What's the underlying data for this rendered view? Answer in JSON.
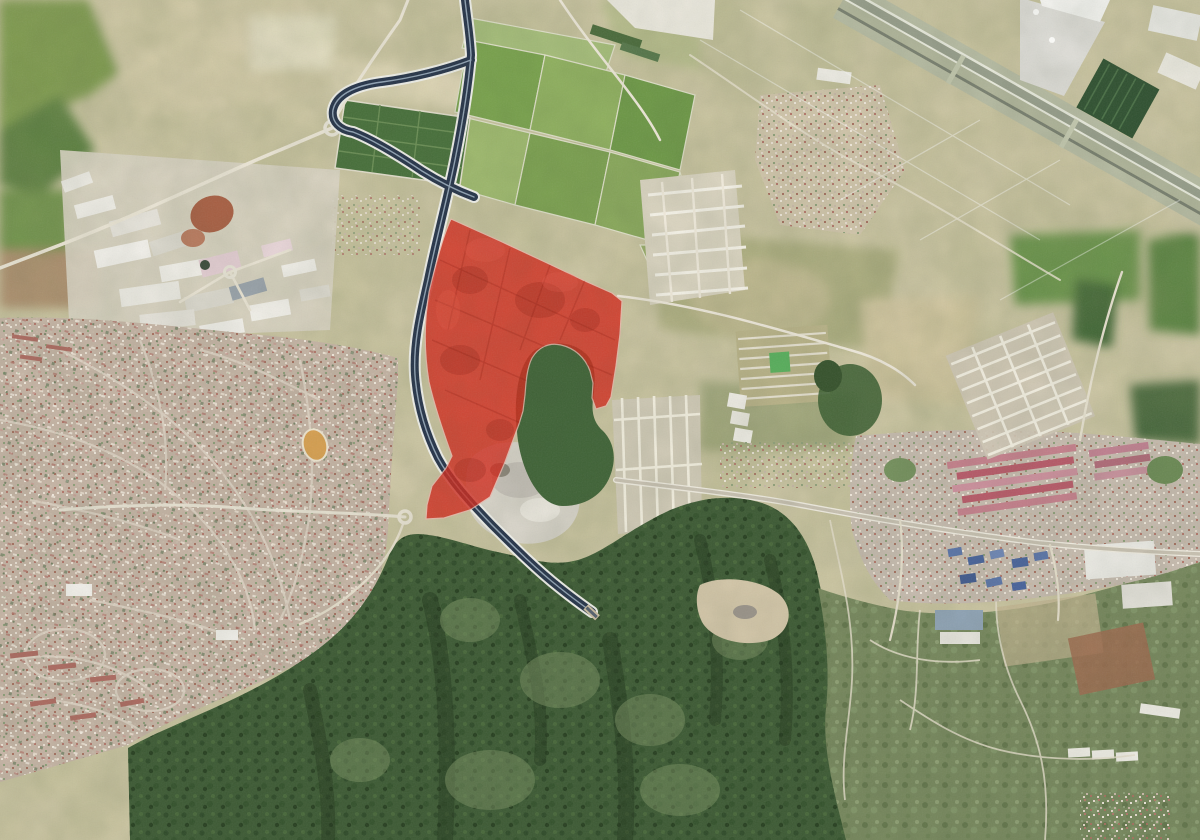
{
  "meta": {
    "title": "Satellite aerial photograph with a highlighted land parcel",
    "type": "satellite-photo",
    "width_px": 1200,
    "height_px": 840,
    "description": "Aerial view of a peri-urban valley: a motorway curves from a junction at the top down to a tunnel portal in a forested mountain range at the bottom; an airport runway crosses the top-right corner; dense residential fabric fills the lower-left; a town lines an east-west road on the right; a large red polygon overlay highlights a land parcel east of the motorway with a green wooded notch cut out of its lower edge."
  },
  "colors": {
    "farmland": "#cfc8a6",
    "farmland_light": "#ddd4b4",
    "farmland_green": "#7aa04b",
    "orchard_dark": "#47703a",
    "forest": "#3c5a33",
    "forest_dark": "#243e1e",
    "scrub": "#76875c",
    "residential": "#c5b4a4",
    "industrial_white": "#f0eee6",
    "town_pink": "#c57f8b",
    "town_red": "#b85968",
    "roof_blue": "#54719f",
    "motorway": "#253349",
    "motorway_casing": "#f0f0ea",
    "road_minor": "#ece6d6",
    "runway_band": "#aab094",
    "runway_tarmac": "#979e8b",
    "overlay_red": "#d5281b",
    "overlay_red_dark": "#8e1b0e",
    "overlay_halo": "#f0b9ae",
    "quarry": "#d7d3c8",
    "bare_soil": "#a85f43"
  },
  "overlay": {
    "label": "highlighted-parcel",
    "fill": "#d5281b",
    "opacity": "0.8",
    "outline_path": "M451,219 L500,241 L545,262 L585,281 L612,293 L622,301 L620,334 L616,366 L611,397 L606,406 L596,409 L592,398 L593,383 L590,371 C585,357 574,348 561,345 C548,342 538,348 532,358 C527,368 526,381 525,395 L523,411 L519,424 L505,462 L490,497 L470,510 L444,518 L426,519 L427,505 L432,486 L446,468 L452,456 C444,434 435,408 429,382 C424,352 424,322 429,292 C436,262 443,236 451,219 Z"
  },
  "motorway": {
    "label": "motorway",
    "stroke": "#253349",
    "casing": "#f0f0ea",
    "main_path": "M465,0 C467,18 470,36 471,55 C468,90 462,125 455,160 C447,200 436,240 428,280 C420,315 413,345 415,375 C417,402 424,430 438,458 C450,480 468,500 492,525 C515,548 537,570 560,588 C575,600 585,607 592,612 M471,60 C445,70 412,78 382,82 C352,86 336,96 333,110 C331,122 340,130 353,132 C374,140 401,157 422,171 C441,183 458,191 474,197",
    "tunnel_transform": "translate(592,612) rotate(43)"
  },
  "airport": {
    "label": "runway",
    "angle_deg": 29.5,
    "transform": "translate(860,-10) rotate(29.5)"
  },
  "landmarks": [
    {
      "name": "motorway-junction",
      "x": 470,
      "y": 60
    },
    {
      "name": "loop-ramp",
      "x": 360,
      "y": 100
    },
    {
      "name": "roundabout-west",
      "x": 332,
      "y": 128
    },
    {
      "name": "roundabout-small",
      "x": 230,
      "y": 272
    },
    {
      "name": "interchange-south",
      "x": 405,
      "y": 517
    },
    {
      "name": "tunnel-portal",
      "x": 592,
      "y": 612
    },
    {
      "name": "quarry",
      "x": 525,
      "y": 490
    },
    {
      "name": "airport-terminal",
      "x": 1080,
      "y": 30
    },
    {
      "name": "airport-dark-lot",
      "x": 1117,
      "y": 98
    },
    {
      "name": "village-north",
      "x": 815,
      "y": 130
    },
    {
      "name": "grid-urbanization-north",
      "x": 690,
      "y": 240
    },
    {
      "name": "grid-urbanization-central",
      "x": 660,
      "y": 470
    },
    {
      "name": "greenhouse-rows",
      "x": 783,
      "y": 365
    },
    {
      "name": "town-east",
      "x": 1020,
      "y": 520
    },
    {
      "name": "residential-west",
      "x": 180,
      "y": 500
    },
    {
      "name": "industrial-northwest",
      "x": 190,
      "y": 250
    },
    {
      "name": "orchard-grid",
      "x": 405,
      "y": 140
    },
    {
      "name": "green-farmland",
      "x": 580,
      "y": 140
    },
    {
      "name": "mountain-forest",
      "x": 480,
      "y": 700
    },
    {
      "name": "scrub-hills-southeast",
      "x": 1000,
      "y": 700
    }
  ]
}
